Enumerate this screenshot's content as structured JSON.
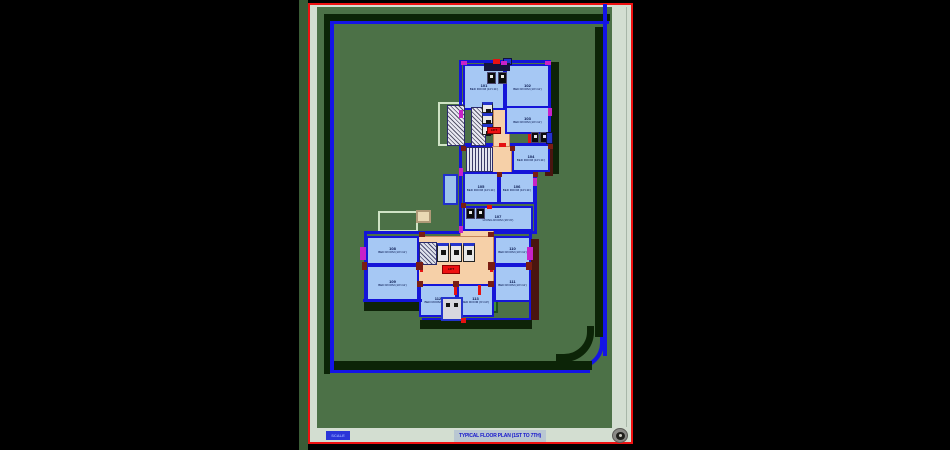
{
  "viewport": {
    "background": "#000000",
    "gutter_color": "#3a5c36"
  },
  "sheet": {
    "border_color": "#ee1111",
    "paper_color": "#d3ded1",
    "drawing_bg": "#4c7147",
    "title": "TYPICAL FLOOR PLAN (1ST TO 7TH)",
    "title_color": "#1515cc",
    "title_highlight": "#b9c7d2",
    "scale_tag": "SCALE",
    "compass_icon": "north-compass-icon"
  },
  "boundary": {
    "line_color": "#1414e6",
    "band_color": "#0c2407",
    "lines": [
      {
        "r": [
          331,
          21,
          278,
          3
        ]
      },
      {
        "r": [
          330,
          21,
          4,
          352
        ]
      },
      {
        "r": [
          330,
          370,
          260,
          3
        ]
      },
      {
        "r": [
          603,
          4,
          4,
          352
        ]
      }
    ],
    "bands": [
      {
        "r": [
          326,
          14,
          284,
          7
        ]
      },
      {
        "r": [
          324,
          14,
          6,
          360
        ]
      },
      {
        "r": [
          330,
          361,
          262,
          9
        ]
      },
      {
        "r": [
          595,
          27,
          8,
          310
        ]
      }
    ]
  },
  "plan": {
    "room_fill": "#a6c8f4",
    "wall_color": "#1414d8",
    "corridor_fill": "#f6d0a8",
    "label_color": "#001048",
    "rooms": [
      {
        "r": [
          463,
          64,
          42,
          46
        ],
        "num": "101",
        "nm": "BED ROOM (10'×11')"
      },
      {
        "r": [
          505,
          64,
          45,
          46
        ],
        "num": "102",
        "nm": "BED ROOM (10'×11')"
      },
      {
        "r": [
          505,
          106,
          45,
          28
        ],
        "num": "103",
        "nm": "BED ROOM (10'×11')"
      },
      {
        "r": [
          512,
          144,
          38,
          28
        ],
        "num": "104",
        "nm": "BED ROOM (10'×11')"
      },
      {
        "r": [
          463,
          172,
          36,
          32
        ],
        "num": "105",
        "nm": "BED ROOM (10'×11')"
      },
      {
        "r": [
          499,
          172,
          36,
          32
        ],
        "num": "106",
        "nm": "BED ROOM (10'×11')"
      },
      {
        "r": [
          463,
          206,
          70,
          25
        ],
        "num": "107",
        "nm": "LIVING ROOM (16'×9')"
      },
      {
        "r": [
          366,
          236,
          53,
          29
        ],
        "num": "108",
        "nm": "BED ROOM (10'×11')"
      },
      {
        "r": [
          366,
          265,
          53,
          36
        ],
        "num": "109",
        "nm": "BED ROOM (10'×11')"
      },
      {
        "r": [
          494,
          236,
          37,
          29
        ],
        "num": "110",
        "nm": "BED ROOM (10'×11')"
      },
      {
        "r": [
          494,
          265,
          37,
          37
        ],
        "num": "111",
        "nm": "BED ROOM (10'×11')"
      },
      {
        "r": [
          419,
          284,
          38,
          33
        ],
        "num": "112",
        "nm": "BED ROOM (9'×10')"
      },
      {
        "r": [
          457,
          284,
          37,
          33
        ],
        "num": "113",
        "nm": "BED ROOM (9'×10')"
      }
    ],
    "corridors": [
      {
        "r": [
          493,
          100,
          17,
          48
        ]
      },
      {
        "r": [
          492,
          146,
          20,
          28
        ]
      },
      {
        "r": [
          418,
          236,
          76,
          49
        ]
      },
      {
        "r": [
          460,
          229,
          34,
          8
        ]
      }
    ],
    "stairs": [
      {
        "r": [
          471,
          107,
          15,
          39
        ],
        "kind": "cross"
      },
      {
        "r": [
          447,
          105,
          18,
          41
        ],
        "kind": "cross"
      },
      {
        "r": [
          466,
          147,
          27,
          25
        ],
        "kind": "vst"
      },
      {
        "r": [
          419,
          242,
          18,
          23
        ],
        "kind": "dst"
      }
    ],
    "fixtures": [
      {
        "r": [
          487,
          72,
          9,
          12
        ],
        "t": "wc"
      },
      {
        "r": [
          498,
          72,
          9,
          12
        ],
        "t": "wc"
      },
      {
        "r": [
          531,
          132,
          8,
          11
        ],
        "t": "wc"
      },
      {
        "r": [
          540,
          132,
          8,
          11
        ],
        "t": "wc"
      },
      {
        "r": [
          466,
          208,
          9,
          11
        ],
        "t": "wc"
      },
      {
        "r": [
          476,
          208,
          9,
          11
        ],
        "t": "wc"
      },
      {
        "r": [
          482,
          102,
          11,
          11
        ],
        "t": "unit"
      },
      {
        "r": [
          482,
          113,
          11,
          11
        ],
        "t": "unit"
      },
      {
        "r": [
          482,
          124,
          11,
          11
        ],
        "t": "unit"
      },
      {
        "r": [
          437,
          243,
          12,
          19
        ],
        "t": "unit"
      },
      {
        "r": [
          450,
          243,
          12,
          19
        ],
        "t": "unit"
      },
      {
        "r": [
          463,
          243,
          12,
          19
        ],
        "t": "unit"
      },
      {
        "r": [
          441,
          297,
          22,
          24
        ],
        "t": "sink"
      },
      {
        "r": [
          546,
          132,
          7,
          12
        ],
        "t": "blue"
      },
      {
        "r": [
          503,
          58,
          9,
          7
        ],
        "t": "blue"
      }
    ],
    "marks": [
      {
        "r": [
          484,
          63,
          26,
          8
        ],
        "c": "#14143c"
      },
      {
        "r": [
          461,
          61,
          6,
          4
        ],
        "c": "#c822c8"
      },
      {
        "r": [
          501,
          61,
          6,
          4
        ],
        "c": "#c822c8"
      },
      {
        "r": [
          545,
          61,
          6,
          4
        ],
        "c": "#c822c8"
      },
      {
        "r": [
          459,
          110,
          4,
          8
        ],
        "c": "#c822c8"
      },
      {
        "r": [
          548,
          108,
          4,
          8
        ],
        "c": "#c822c8"
      },
      {
        "r": [
          459,
          168,
          4,
          8
        ],
        "c": "#c822c8"
      },
      {
        "r": [
          533,
          178,
          4,
          8
        ],
        "c": "#c822c8"
      },
      {
        "r": [
          459,
          226,
          4,
          7
        ],
        "c": "#c822c8"
      },
      {
        "r": [
          360,
          247,
          6,
          13
        ],
        "c": "#c822c8"
      },
      {
        "r": [
          527,
          247,
          6,
          13
        ],
        "c": "#c822c8"
      },
      {
        "r": [
          493,
          59,
          7,
          5
        ],
        "c": "#e51212"
      },
      {
        "r": [
          499,
          143,
          7,
          4
        ],
        "c": "#e51212"
      },
      {
        "r": [
          528,
          134,
          3,
          9
        ],
        "c": "#e51212"
      },
      {
        "r": [
          487,
          205,
          5,
          4
        ],
        "c": "#e51212"
      },
      {
        "r": [
          420,
          263,
          3,
          9
        ],
        "c": "#e51212"
      },
      {
        "r": [
          490,
          263,
          3,
          9
        ],
        "c": "#e51212"
      },
      {
        "r": [
          454,
          285,
          3,
          10
        ],
        "c": "#e51212"
      },
      {
        "r": [
          478,
          285,
          3,
          10
        ],
        "c": "#e51212"
      },
      {
        "r": [
          461,
          318,
          5,
          5
        ],
        "c": "#e51212"
      },
      {
        "r": [
          416,
          262,
          7,
          8
        ],
        "c": "#7a1d12"
      },
      {
        "r": [
          488,
          262,
          7,
          8
        ],
        "c": "#7a1d12"
      },
      {
        "r": [
          362,
          262,
          5,
          8
        ],
        "c": "#7a1d12"
      },
      {
        "r": [
          526,
          262,
          6,
          8
        ],
        "c": "#7a1d12"
      },
      {
        "r": [
          453,
          281,
          6,
          6
        ],
        "c": "#7a1d12"
      },
      {
        "r": [
          417,
          281,
          6,
          6
        ],
        "c": "#7a1d12"
      },
      {
        "r": [
          488,
          281,
          6,
          6
        ],
        "c": "#7a1d12"
      },
      {
        "r": [
          461,
          146,
          5,
          5
        ],
        "c": "#7a1d12"
      },
      {
        "r": [
          510,
          146,
          5,
          5
        ],
        "c": "#7a1d12"
      },
      {
        "r": [
          533,
          172,
          5,
          5
        ],
        "c": "#7a1d12"
      },
      {
        "r": [
          548,
          144,
          5,
          5
        ],
        "c": "#7a1d12"
      },
      {
        "r": [
          461,
          203,
          5,
          5
        ],
        "c": "#7a1d12"
      },
      {
        "r": [
          497,
          172,
          5,
          5
        ],
        "c": "#7a1d12"
      },
      {
        "r": [
          419,
          232,
          6,
          5
        ],
        "c": "#7a1d12"
      },
      {
        "r": [
          488,
          232,
          6,
          5
        ],
        "c": "#7a1d12"
      }
    ],
    "shadows": [
      {
        "r": [
          551,
          62,
          8,
          112
        ],
        "c": "#0e2308"
      },
      {
        "r": [
          420,
          320,
          112,
          9
        ],
        "c": "#0e2308"
      },
      {
        "r": [
          364,
          302,
          56,
          9
        ],
        "c": "#0e2308"
      },
      {
        "r": [
          545,
          146,
          8,
          30
        ],
        "c": "#4a150f"
      },
      {
        "r": [
          531,
          239,
          8,
          81
        ],
        "c": "#4a150f"
      }
    ],
    "outlines": [
      {
        "r": [
          438,
          102,
          27,
          44
        ],
        "b": "#cfe3c5"
      },
      {
        "r": [
          378,
          211,
          40,
          21
        ],
        "b": "#cfe3c5"
      },
      {
        "r": [
          443,
          174,
          15,
          31
        ],
        "b": "#2030cc",
        "bg": "#9cc2ec"
      },
      {
        "r": [
          416,
          210,
          15,
          13
        ],
        "b": "#b09a78",
        "bg": "#ead9b4"
      },
      {
        "r": [
          484,
          299,
          14,
          14
        ],
        "b": "#1c4f1c",
        "bg": "#3f8f3f"
      }
    ],
    "walls": [
      {
        "r": [
          459,
          60,
          92,
          86
        ]
      },
      {
        "r": [
          459,
          144,
          78,
          90
        ]
      },
      {
        "r": [
          364,
          231,
          168,
          90
        ]
      }
    ],
    "patches": [
      {
        "r": [
          361,
          301,
          61,
          22
        ]
      }
    ],
    "wall_segments": [
      {
        "r": [
          363,
          299,
          59,
          3
        ]
      }
    ],
    "red_labels": [
      {
        "r": [
          487,
          127,
          14,
          7
        ],
        "text": "LIFT"
      },
      {
        "r": [
          442,
          265,
          18,
          9
        ],
        "text": "LIFT"
      }
    ]
  }
}
